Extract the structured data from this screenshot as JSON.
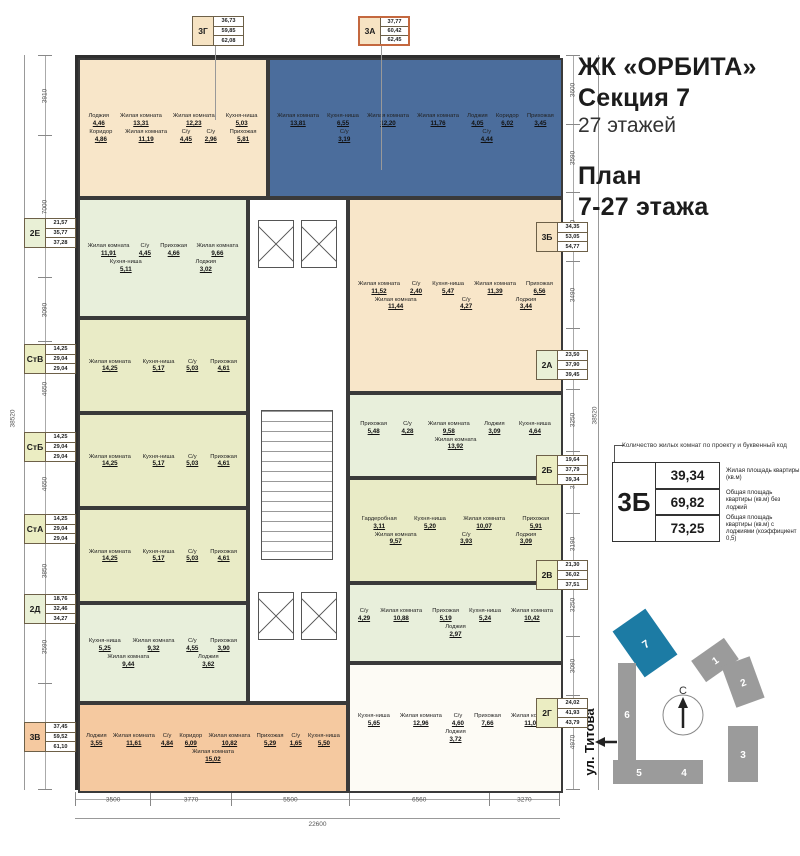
{
  "header": {
    "project": "ЖК «ОРБИТА»",
    "section": "Секция 7",
    "floors": "27 этажей",
    "plan1": "План",
    "plan2": "7-27 этажа"
  },
  "legend": {
    "callout": "Количество жилых комнат по проекту и буквенный код",
    "code": "3Б",
    "rows": [
      {
        "value": "39,34",
        "label": "Жилая площадь квартиры (кв.м)"
      },
      {
        "value": "69,82",
        "label": "Общая площадь квартиры (кв.м) без лоджий"
      },
      {
        "value": "73,25",
        "label": "Общая площадь квартиры (кв.м) с лоджиями (коэффициент 0,5)"
      }
    ]
  },
  "site_map": {
    "street": "ул. Титова",
    "compass": "С",
    "sections": [
      "1",
      "2",
      "3",
      "4",
      "5",
      "6",
      "7"
    ],
    "highlighted_section": "7",
    "highlight_color": "#1c7ba4",
    "building_color": "#9b9b9b"
  },
  "dimensions": {
    "left": [
      "3910",
      "7000",
      "3090",
      "4650",
      "4650",
      "3850",
      "3590",
      "5190"
    ],
    "left_total": "38520",
    "right": [
      "3600",
      "3590",
      "3650",
      "3490",
      "3190",
      "3250",
      "3250",
      "3190",
      "3250",
      "3090",
      "4970"
    ],
    "right_total": "38520",
    "bottom": [
      "3500",
      "3770",
      "5500",
      "6560",
      "3270"
    ],
    "bottom_total": "22600"
  },
  "apartments": [
    {
      "code": "3Г",
      "box_values": [
        "36,73",
        "59,85",
        "62,08"
      ],
      "fill": "#f8e6c9",
      "box_fill": "#f6e3c3",
      "rooms": [
        {
          "name": "Лоджия",
          "area": "4,46"
        },
        {
          "name": "Жилая комната",
          "area": "13,31"
        },
        {
          "name": "Жилая комната",
          "area": "12,23"
        },
        {
          "name": "Кухня-ниша",
          "area": "5,03"
        },
        {
          "name": "Коридор",
          "area": "4,86"
        },
        {
          "name": "Жилая комната",
          "area": "11,19"
        },
        {
          "name": "С/у",
          "area": "4,45"
        },
        {
          "name": "С/у",
          "area": "2,96"
        },
        {
          "name": "Прихожая",
          "area": "5,81"
        }
      ]
    },
    {
      "code": "3А",
      "box_values": [
        "37,77",
        "60,42",
        "62,45"
      ],
      "fill": "#4b6d9c",
      "box_fill": "#f6e3c3",
      "rooms": [
        {
          "name": "Жилая комната",
          "area": "13,81"
        },
        {
          "name": "Кухня-ниша",
          "area": "6,55"
        },
        {
          "name": "Жилая комната",
          "area": "12,20"
        },
        {
          "name": "Жилая комната",
          "area": "11,76"
        },
        {
          "name": "Лоджия",
          "area": "4,05"
        },
        {
          "name": "Коридор",
          "area": "6,02"
        },
        {
          "name": "Прихожая",
          "area": "3,45"
        },
        {
          "name": "С/у",
          "area": "3,19"
        },
        {
          "name": "С/у",
          "area": "4,44"
        }
      ]
    },
    {
      "code": "3Б",
      "box_values": [
        "34,35",
        "53,05",
        "54,77"
      ],
      "fill": "#f8e6c9",
      "box_fill": "#f6e3c3",
      "rooms": [
        {
          "name": "Жилая комната",
          "area": "11,52"
        },
        {
          "name": "С/у",
          "area": "2,40"
        },
        {
          "name": "Кухня-ниша",
          "area": "5,47"
        },
        {
          "name": "Жилая комната",
          "area": "11,39"
        },
        {
          "name": "Прихожая",
          "area": "6,56"
        },
        {
          "name": "Жилая комната",
          "area": "11,44"
        },
        {
          "name": "С/у",
          "area": "4,27"
        },
        {
          "name": "Лоджия",
          "area": "3,44"
        }
      ]
    },
    {
      "code": "2Е",
      "box_values": [
        "21,57",
        "35,77",
        "37,28"
      ],
      "fill": "#e8efdb",
      "box_fill": "#e9f0d6",
      "rooms": [
        {
          "name": "Жилая комната",
          "area": "11,91"
        },
        {
          "name": "С/у",
          "area": "4,45"
        },
        {
          "name": "Прихожая",
          "area": "4,66"
        },
        {
          "name": "Жилая комната",
          "area": "9,66"
        },
        {
          "name": "Кухня-ниша",
          "area": "5,11"
        },
        {
          "name": "Лоджия",
          "area": "3,02"
        }
      ]
    },
    {
      "code": "СтВ",
      "box_values": [
        "14,25",
        "29,04",
        "29,04"
      ],
      "fill": "#e9ebc6",
      "box_fill": "#ebedc2",
      "rooms": [
        {
          "name": "Жилая комната",
          "area": "14,25"
        },
        {
          "name": "Кухня-ниша",
          "area": "5,17"
        },
        {
          "name": "С/у",
          "area": "5,03"
        },
        {
          "name": "Прихожая",
          "area": "4,61"
        }
      ]
    },
    {
      "code": "СтБ",
      "box_values": [
        "14,25",
        "29,04",
        "29,04"
      ],
      "fill": "#e9ebc6",
      "box_fill": "#ebedc2",
      "rooms": [
        {
          "name": "Жилая комната",
          "area": "14,25"
        },
        {
          "name": "Кухня-ниша",
          "area": "5,17"
        },
        {
          "name": "С/у",
          "area": "5,03"
        },
        {
          "name": "Прихожая",
          "area": "4,61"
        }
      ]
    },
    {
      "code": "СтА",
      "box_values": [
        "14,25",
        "29,04",
        "29,04"
      ],
      "fill": "#e9ebc6",
      "box_fill": "#ebedc2",
      "rooms": [
        {
          "name": "Жилая комната",
          "area": "14,25"
        },
        {
          "name": "Кухня-ниша",
          "area": "5,17"
        },
        {
          "name": "С/у",
          "area": "5,03"
        },
        {
          "name": "Прихожая",
          "area": "4,61"
        }
      ]
    },
    {
      "code": "2Д",
      "box_values": [
        "18,76",
        "32,46",
        "34,27"
      ],
      "fill": "#e8efdb",
      "box_fill": "#e9f0d6",
      "rooms": [
        {
          "name": "Кухня-ниша",
          "area": "5,25"
        },
        {
          "name": "Жилая комната",
          "area": "9,32"
        },
        {
          "name": "С/у",
          "area": "4,55"
        },
        {
          "name": "Прихожая",
          "area": "3,90"
        },
        {
          "name": "Жилая комната",
          "area": "9,44"
        },
        {
          "name": "Лоджия",
          "area": "3,62"
        }
      ]
    },
    {
      "code": "3В",
      "box_values": [
        "37,45",
        "59,52",
        "61,10"
      ],
      "fill": "#f5c9a0",
      "box_fill": "#f5c9a0",
      "rooms": [
        {
          "name": "Лоджия",
          "area": "3,55"
        },
        {
          "name": "Жилая комната",
          "area": "11,61"
        },
        {
          "name": "С/у",
          "area": "4,84"
        },
        {
          "name": "Коридор",
          "area": "6,09"
        },
        {
          "name": "Жилая комната",
          "area": "10,82"
        },
        {
          "name": "Прихожая",
          "area": "5,29"
        },
        {
          "name": "С/у",
          "area": "1,65"
        },
        {
          "name": "Кухня-ниша",
          "area": "5,50"
        },
        {
          "name": "Жилая комната",
          "area": "15,02"
        }
      ]
    },
    {
      "code": "2А",
      "box_values": [
        "23,50",
        "37,90",
        "39,45"
      ],
      "fill": "#e8efdb",
      "box_fill": "#e9f0d6",
      "rooms": [
        {
          "name": "Прихожая",
          "area": "5,48"
        },
        {
          "name": "С/у",
          "area": "4,28"
        },
        {
          "name": "Жилая комната",
          "area": "9,58"
        },
        {
          "name": "Лоджия",
          "area": "3,09"
        },
        {
          "name": "Кухня-ниша",
          "area": "4,64"
        },
        {
          "name": "Жилая комната",
          "area": "13,92"
        }
      ]
    },
    {
      "code": "2Б",
      "box_values": [
        "19,64",
        "37,79",
        "39,34"
      ],
      "fill": "#e9ebc6",
      "box_fill": "#ebedc2",
      "rooms": [
        {
          "name": "Гардеробная",
          "area": "3,11"
        },
        {
          "name": "Кухня-ниша",
          "area": "5,20"
        },
        {
          "name": "Жилая комната",
          "area": "10,07"
        },
        {
          "name": "Прихожая",
          "area": "5,91"
        },
        {
          "name": "Жилая комната",
          "area": "9,57"
        },
        {
          "name": "С/у",
          "area": "3,93"
        },
        {
          "name": "Лоджия",
          "area": "3,09"
        }
      ]
    },
    {
      "code": "2В",
      "box_values": [
        "21,30",
        "36,02",
        "37,51"
      ],
      "fill": "#e8efdb",
      "box_fill": "#ebedc2",
      "rooms": [
        {
          "name": "С/у",
          "area": "4,29"
        },
        {
          "name": "Жилая комната",
          "area": "10,88"
        },
        {
          "name": "Прихожая",
          "area": "5,19"
        },
        {
          "name": "Кухня-ниша",
          "area": "5,24"
        },
        {
          "name": "Жилая комната",
          "area": "10,42"
        },
        {
          "name": "Лоджия",
          "area": "2,97"
        }
      ]
    },
    {
      "code": "2Г",
      "box_values": [
        "24,02",
        "41,93",
        "43,79"
      ],
      "fill": "#fdfbf5",
      "box_fill": "#ebedc2",
      "rooms": [
        {
          "name": "Кухня-ниша",
          "area": "5,65"
        },
        {
          "name": "Жилая комната",
          "area": "12,96"
        },
        {
          "name": "С/у",
          "area": "4,60"
        },
        {
          "name": "Прихожая",
          "area": "7,66"
        },
        {
          "name": "Жилая комната",
          "area": "11,06"
        },
        {
          "name": "Лоджия",
          "area": "3,72"
        }
      ]
    }
  ]
}
